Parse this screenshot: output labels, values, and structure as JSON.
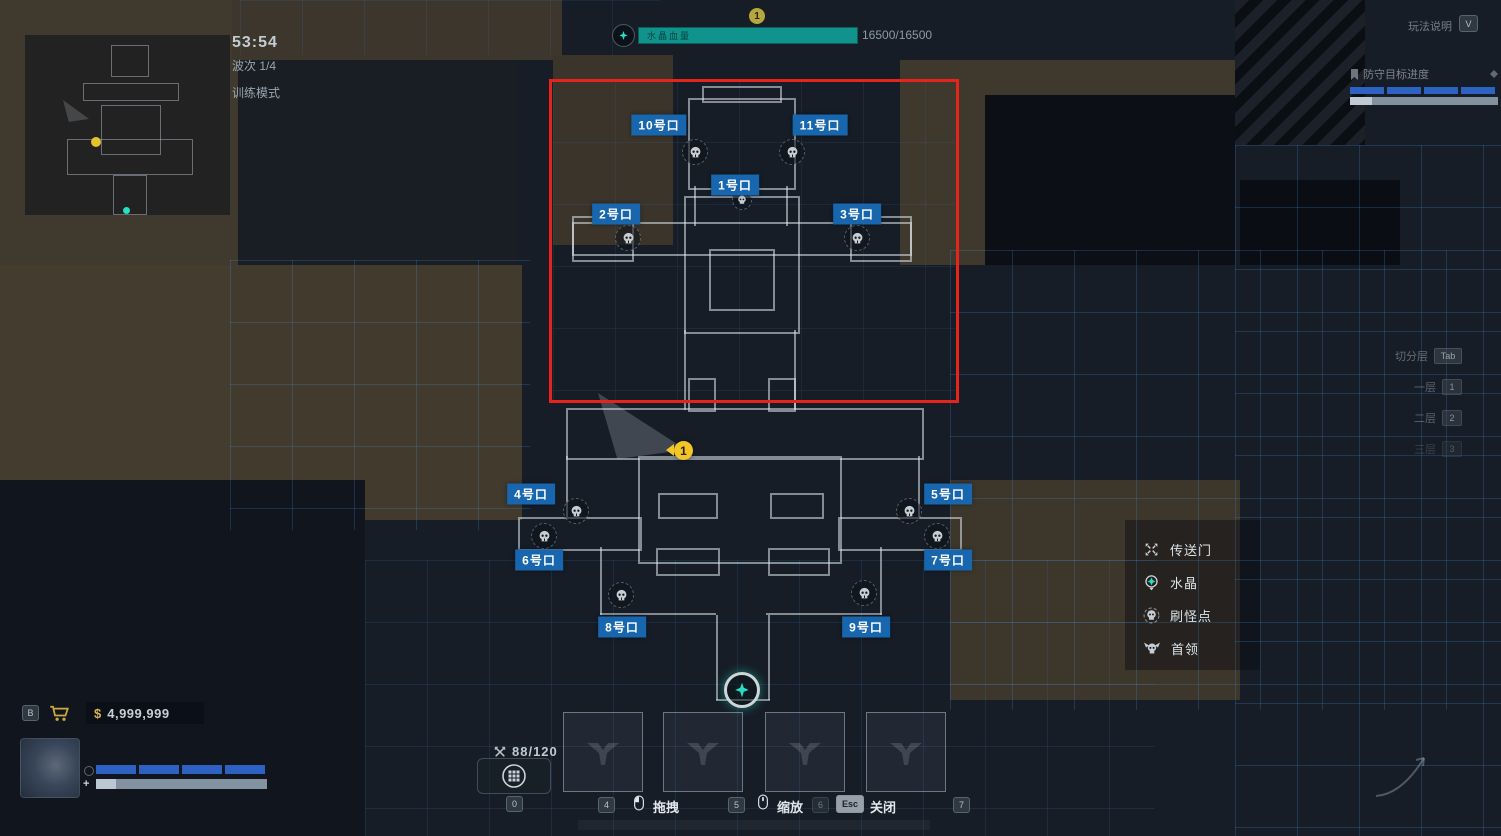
{
  "colors": {
    "gate_blue": "#1766ae",
    "alert_red": "#e8231b",
    "crystal_teal": "#10938c",
    "wave_bar_blue": "#2d62c2"
  },
  "header": {
    "timer": "53:54",
    "wave": "波次 1/4",
    "mode": "训练模式",
    "crystal_name": "水晶血量",
    "crystal_hp": "16500/16500",
    "top_marker": "1",
    "help_label": "玩法说明",
    "help_key": "V"
  },
  "objective": {
    "label": "防守目标进度"
  },
  "floors": {
    "title": "切分层",
    "title_key": "Tab",
    "items": [
      {
        "label": "一层",
        "key": "1"
      },
      {
        "label": "二层",
        "key": "2"
      },
      {
        "label": "三层",
        "key": "3"
      }
    ]
  },
  "legend": [
    {
      "icon": "portal-icon",
      "label": "传送门"
    },
    {
      "icon": "crystal-icon",
      "label": "水晶"
    },
    {
      "icon": "spawn-icon",
      "label": "刷怪点"
    },
    {
      "icon": "boss-icon",
      "label": "首领"
    }
  ],
  "map": {
    "gates": [
      "1号口",
      "2号口",
      "3号口",
      "4号口",
      "5号口",
      "6号口",
      "7号口",
      "8号口",
      "9号口",
      "10号口",
      "11号口"
    ],
    "player_marker": "1"
  },
  "wallet": {
    "key": "B",
    "symbol": "$",
    "amount": "4,999,999"
  },
  "build": {
    "counter": "88/120",
    "key": "0",
    "slot_keys": [
      "4",
      "5",
      "6",
      "7"
    ]
  },
  "hints": {
    "drag": "拖拽",
    "zoom": "缩放",
    "close": "关闭",
    "close_key": "Esc"
  }
}
